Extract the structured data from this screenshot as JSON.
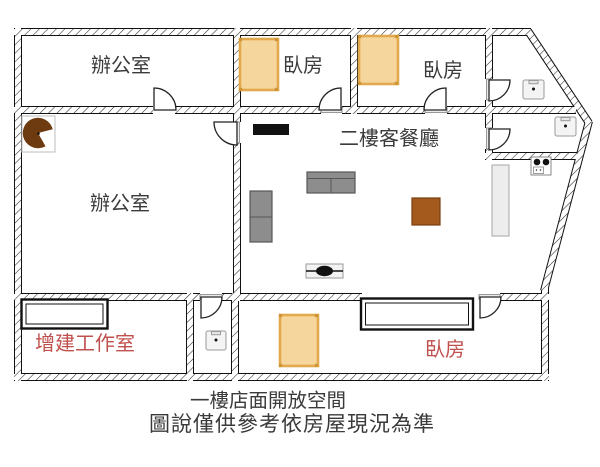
{
  "floor_plan": {
    "rooms": {
      "office_top": {
        "label": "辦公室",
        "color": "#3b3b3b"
      },
      "bedroom_top_1": {
        "label": "臥房",
        "color": "#3b3b3b"
      },
      "bedroom_top_2": {
        "label": "臥房",
        "color": "#3b3b3b"
      },
      "living_dining": {
        "label": "二樓客餐廳",
        "color": "#3b3b3b"
      },
      "office_main": {
        "label": "辦公室",
        "color": "#3b3b3b"
      },
      "workshop": {
        "label": "增建工作室",
        "color": "#c0504d"
      },
      "bedroom_bottom": {
        "label": "臥房",
        "color": "#c0504d"
      }
    },
    "caption": {
      "line1": "一樓店面開放空間",
      "line2": "圖說僅供參考依房屋現況為準"
    },
    "fixtures": {
      "bed_count": 3,
      "sink_count": 3,
      "items": [
        "bed",
        "sink",
        "stove",
        "kitchen-counter",
        "sofa",
        "tv-cabinet",
        "square-table",
        "ceiling-fixture",
        "corner-round-table",
        "closet",
        "door-arc"
      ]
    },
    "colors": {
      "bed_fill": "#f5d69c",
      "bed_border": "#e2a94f",
      "red_label": "#c0504d",
      "table_brown": "#a4591d",
      "corner_table_brown": "#6e3a10",
      "sofa_gray": "#8d8d8d",
      "wall_line": "#111111",
      "counter_gray": "#ededed"
    }
  }
}
